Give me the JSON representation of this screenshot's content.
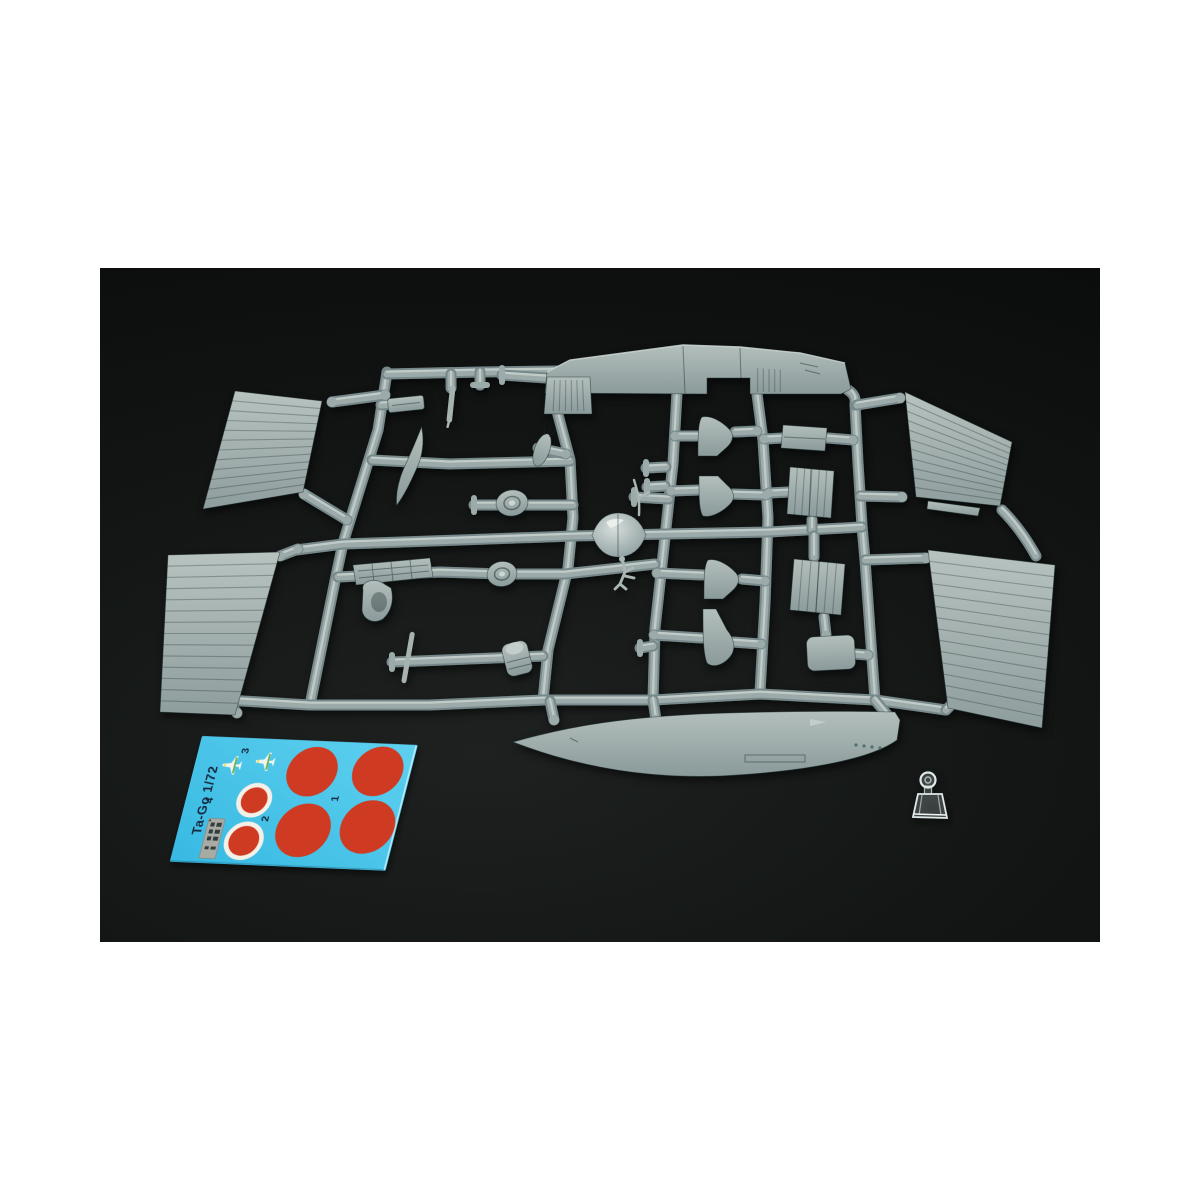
{
  "scene": {
    "type": "product-photo",
    "subject": "injection-molded 1/72 aircraft model kit sprue with decal sheet and clear windscreen part",
    "background": "white page with dark photo area"
  },
  "colors": {
    "page_bg": "#ffffff",
    "photo_bg": "#131615",
    "photo_vignette": "#0a0c0b",
    "plastic_light": "#b9c4c1",
    "plastic_mid": "#9aa8a6",
    "plastic_dark": "#7c8c8c",
    "plastic_edge": "#2e4341",
    "runner_dark": "#77888a",
    "runner_mid": "#9cabaa",
    "runner_hi": "#c9d3d0",
    "decal_cyan": "#3fc2e7",
    "decal_cyan_light": "#5ed0ef",
    "decal_red": "#ce3a21",
    "decal_white": "#f3f0e8",
    "decal_text": "#16293f",
    "decal_plate": "#a8aba3",
    "decal_green": "#6db257",
    "decal_yellow": "#e6e070",
    "clear_part": "#dfe9e9"
  },
  "sprue": {
    "material": "grey styrene",
    "parts": [
      "upper-fuselage-half",
      "lower-fuselage-half",
      "left-wing-outer-panel-upper",
      "left-wing-outer-panel-lower",
      "right-wing-outer-panel-upper",
      "right-wing-outer-panel-lower",
      "wing-center-section-panels",
      "tail-fins-and-stabilizers",
      "propeller-blade",
      "propeller-spinner",
      "main-wheels",
      "pilot-seat",
      "engine-mount-frame",
      "drop-tank",
      "access-hatch",
      "struts-and-small-parts"
    ]
  },
  "decal_sheet": {
    "title": "Ta-Go 1/72",
    "labels": {
      "n1": "1",
      "n2": "2",
      "n3": "3",
      "n4": "4"
    },
    "markings": [
      {
        "label": "1",
        "type": "hinomaru-roundel",
        "count": 4
      },
      {
        "label": "2",
        "type": "hinomaru-roundel-white-border",
        "count": 2
      },
      {
        "label": "3",
        "type": "aircraft-marking",
        "count": 2
      },
      {
        "label": "4",
        "type": "stencil-data-plate",
        "count": 1
      }
    ]
  },
  "clear_parts": {
    "windscreen": 1
  }
}
